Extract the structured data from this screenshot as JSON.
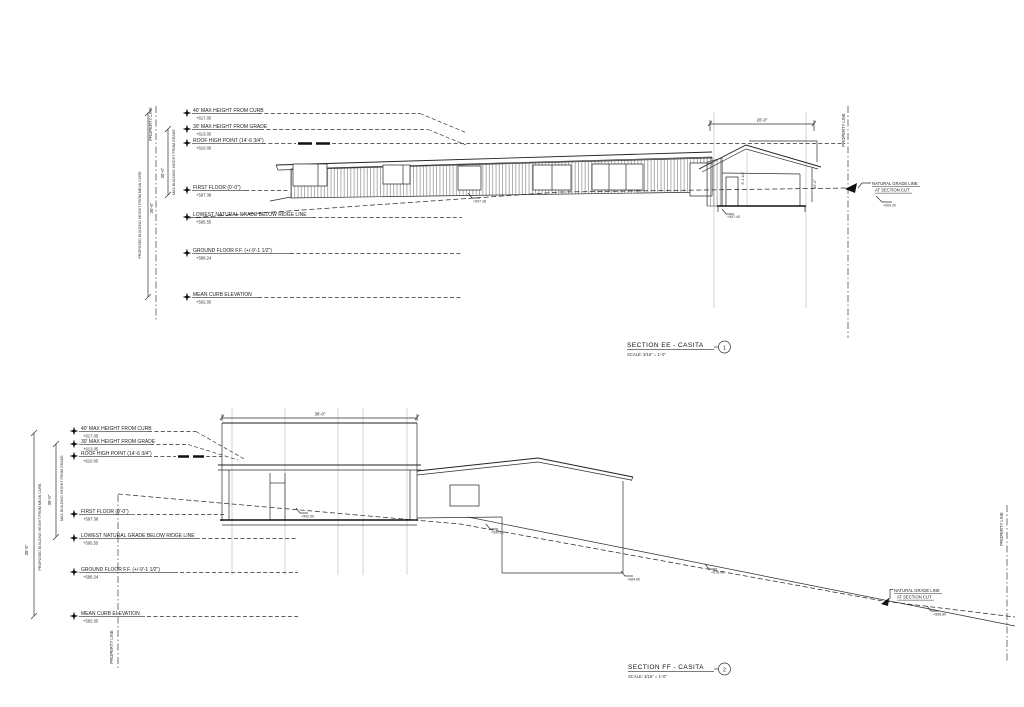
{
  "sheet": {
    "background": "#ffffff",
    "line_color": "#2e2e2e"
  },
  "datums": [
    {
      "label": "40' MAX HEIGHT FROM CURB",
      "value": "+617.05"
    },
    {
      "label": "30' MAX HEIGHT FROM GRADE",
      "value": "+613.05"
    },
    {
      "label": "ROOF HIGH POINT (14'-6 3/4\")",
      "value": "+610.05"
    },
    {
      "label": "FIRST FLOOR (0'-0\")",
      "value": "+597.38"
    },
    {
      "label": "LOWEST NATURAL GRADE BELOW RIDGE LINE",
      "value": "+595.55"
    },
    {
      "label": "GROUND FLOOR F.F. (+/-9'-1 1/2\")",
      "value": "+588.24"
    },
    {
      "label": "MEAN CURB ELEVATION",
      "value": "+582.05"
    }
  ],
  "dims": {
    "proposed_height_label": "PROPOSED BUILDING HEIGHT FROM MEAN CURB",
    "proposed_height_value": "35'-6\"",
    "max_grade_label": "MAX BUILDING HEIGHT FROM GRADE",
    "max_grade_value": "30'-0\"",
    "casita_width_ee": "20'-0\"",
    "casita_width_ff": "36'-0\"",
    "casita_interior_height": "9'-1 1/2\"",
    "casita_right_height": "10'-0\""
  },
  "labels": {
    "property_line": "PROPERTY LINE",
    "natural_grade_line": "NATURAL GRADE LINE",
    "at_section_cut": "AT SECTION CUT"
  },
  "spots": {
    "ee_door": "+597.38",
    "ee_casita_floor": "+597.40",
    "ee_grade_right": "+604.20",
    "ff_grade_box": "+592.50",
    "ff_grade_mid": "+590.80",
    "ff_wall_base": "+584.60",
    "ff_grade_slope": "+578.90",
    "ff_grade_right": "+568.80"
  },
  "sections": [
    {
      "title": "SECTION EE - CASITA",
      "scale": "SCALE: 3/16\" = 1'-0\"",
      "number": "1"
    },
    {
      "title": "SECTION FF - CASITA",
      "scale": "SCALE: 3/16\" = 1'-0\"",
      "number": "2"
    }
  ]
}
